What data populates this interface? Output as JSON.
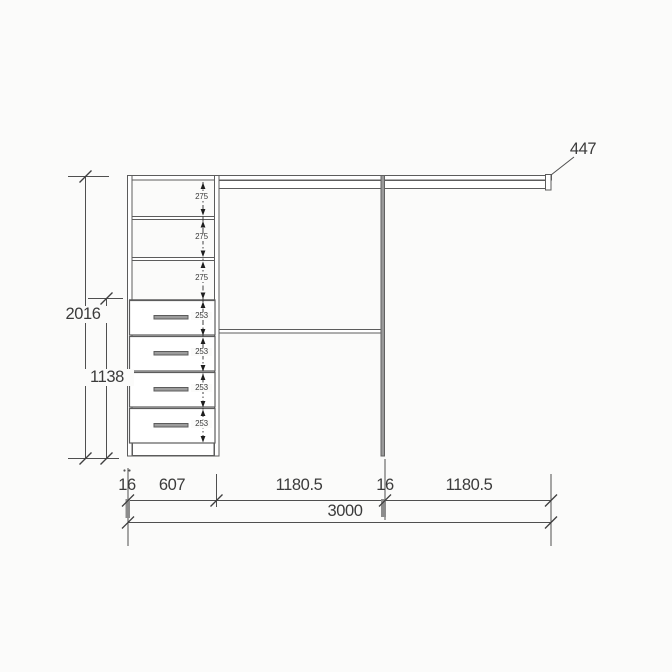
{
  "drawing_type": "wardrobe-elevation-dimension-drawing",
  "colors": {
    "background": "#fbfbfa",
    "structure_line": "#5c5c5c",
    "dimension_line": "#4f4f4f",
    "text": "#3b3b3b",
    "panel_thickness_fill": "#8c8c8c",
    "divider_fill": "#9a9a9a",
    "handle_fill": "#9c9c9c"
  },
  "dims": {
    "top_shelf_label": "447",
    "total_height": "2016",
    "lower_section_height": "1138",
    "bottom_row": [
      "16",
      "607",
      "1180.5",
      "16",
      "1180.5"
    ],
    "total_width": "3000"
  },
  "shelf_sections": [
    {
      "label": "275"
    },
    {
      "label": "275"
    },
    {
      "label": "275"
    }
  ],
  "drawers": [
    {
      "label": "253"
    },
    {
      "label": "253"
    },
    {
      "label": "253"
    },
    {
      "label": "253"
    }
  ]
}
